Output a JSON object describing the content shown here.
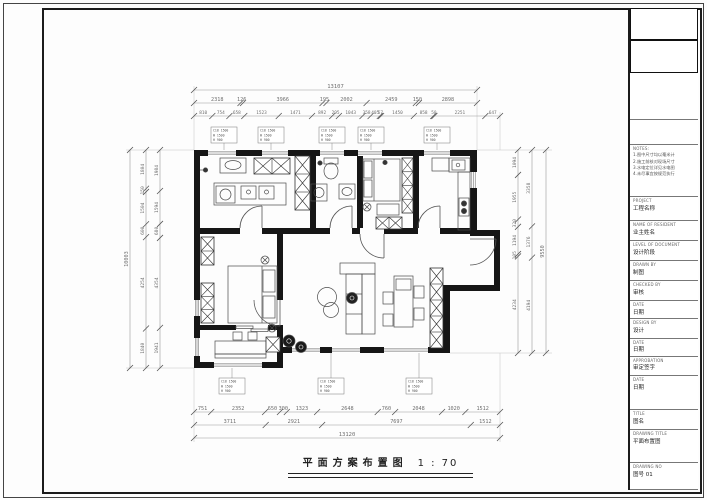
{
  "title": {
    "text": "平面方案布置图",
    "scale": "1 : 70"
  },
  "dims": {
    "top_overall": [
      "13107"
    ],
    "top_row2": [
      "2318",
      "126",
      "3966",
      "195",
      "2002",
      "2459",
      "150",
      "2898"
    ],
    "top_row3": [
      "810",
      "754",
      "658",
      "1523",
      "1471",
      "892",
      "295",
      "1043",
      "358",
      "405",
      "57",
      "1450",
      "858",
      "50",
      "2251",
      "647"
    ],
    "bottom_row1": [
      "751",
      "2352",
      "650",
      "300",
      "1323",
      "2648",
      "760",
      "2048",
      "1020",
      "1512"
    ],
    "bottom_row2": [
      "3711",
      "2921",
      "7697",
      "1512"
    ],
    "bottom_overall": [
      "13120"
    ],
    "left_col1": [
      "1804",
      "150",
      "1504",
      "600",
      "4254",
      "1840"
    ],
    "left_col2": [
      "1984",
      "1594",
      "680",
      "4354",
      "1941"
    ],
    "left_overall": [
      "10003"
    ],
    "right_col1": [
      "1094",
      "1955",
      "320",
      "1194",
      "105",
      "4234"
    ],
    "right_col2": [
      "3358",
      "1376",
      "4194"
    ],
    "right_overall": [
      "9550"
    ]
  },
  "callouts": {
    "top": [
      {
        "lines": [
          "C18 1500",
          "W 1500",
          "H 900"
        ]
      },
      {
        "lines": [
          "C18 1500",
          "W 1500",
          "H 900"
        ]
      },
      {
        "lines": [
          "C18 1500",
          "W 1500",
          "H 900"
        ]
      },
      {
        "lines": [
          "C18 1500",
          "W 1500",
          "H 900"
        ]
      },
      {
        "lines": [
          "C18 1500",
          "W 1500",
          "H 900"
        ]
      }
    ],
    "bottom": [
      {
        "lines": [
          "C18 1500",
          "W 1500",
          "H 900"
        ]
      },
      {
        "lines": [
          "C18 1500",
          "W 1500",
          "H 900"
        ]
      },
      {
        "lines": [
          "C18 1500",
          "W 1500",
          "H 900"
        ]
      }
    ]
  },
  "title_block": {
    "cells": [
      {
        "label": "",
        "value": ""
      },
      {
        "label": "",
        "value": ""
      },
      {
        "label": "",
        "value": ""
      },
      {
        "label": "",
        "value": ""
      },
      {
        "label": "NOTES:",
        "value": "1.图中尺寸均以毫米计\n2.施工前核对现场尺寸\n3.水电定位详见水电图\n4.未尽事宜按规范执行"
      },
      {
        "label": "PROJECT",
        "value": "工程名称"
      },
      {
        "label": "NAME OF RESIDENT",
        "value": "业主姓名"
      },
      {
        "label": "LEVEL OF DOCUMENT",
        "value": "设计阶段"
      },
      {
        "label": "DRAWN BY",
        "value": "制图"
      },
      {
        "label": "CHECKED BY",
        "value": "审核"
      },
      {
        "label": "DATE",
        "value": "日期"
      },
      {
        "label": "DESIGN BY",
        "value": "设计"
      },
      {
        "label": "DATE",
        "value": "日期"
      },
      {
        "label": "APPROBATION",
        "value": "审定签字"
      },
      {
        "label": "DATE",
        "value": "日期"
      },
      {
        "label": "TITLE",
        "value": "图名"
      },
      {
        "label": "DRAWING TITLE",
        "value": "平面布置图"
      },
      {
        "label": "DRAWING NO",
        "value": "图号 01"
      }
    ]
  },
  "colors": {
    "wall": "#161616",
    "dim_line": "#999999",
    "dim_text": "#6e6e6e",
    "furniture": "#4a4a4a"
  }
}
